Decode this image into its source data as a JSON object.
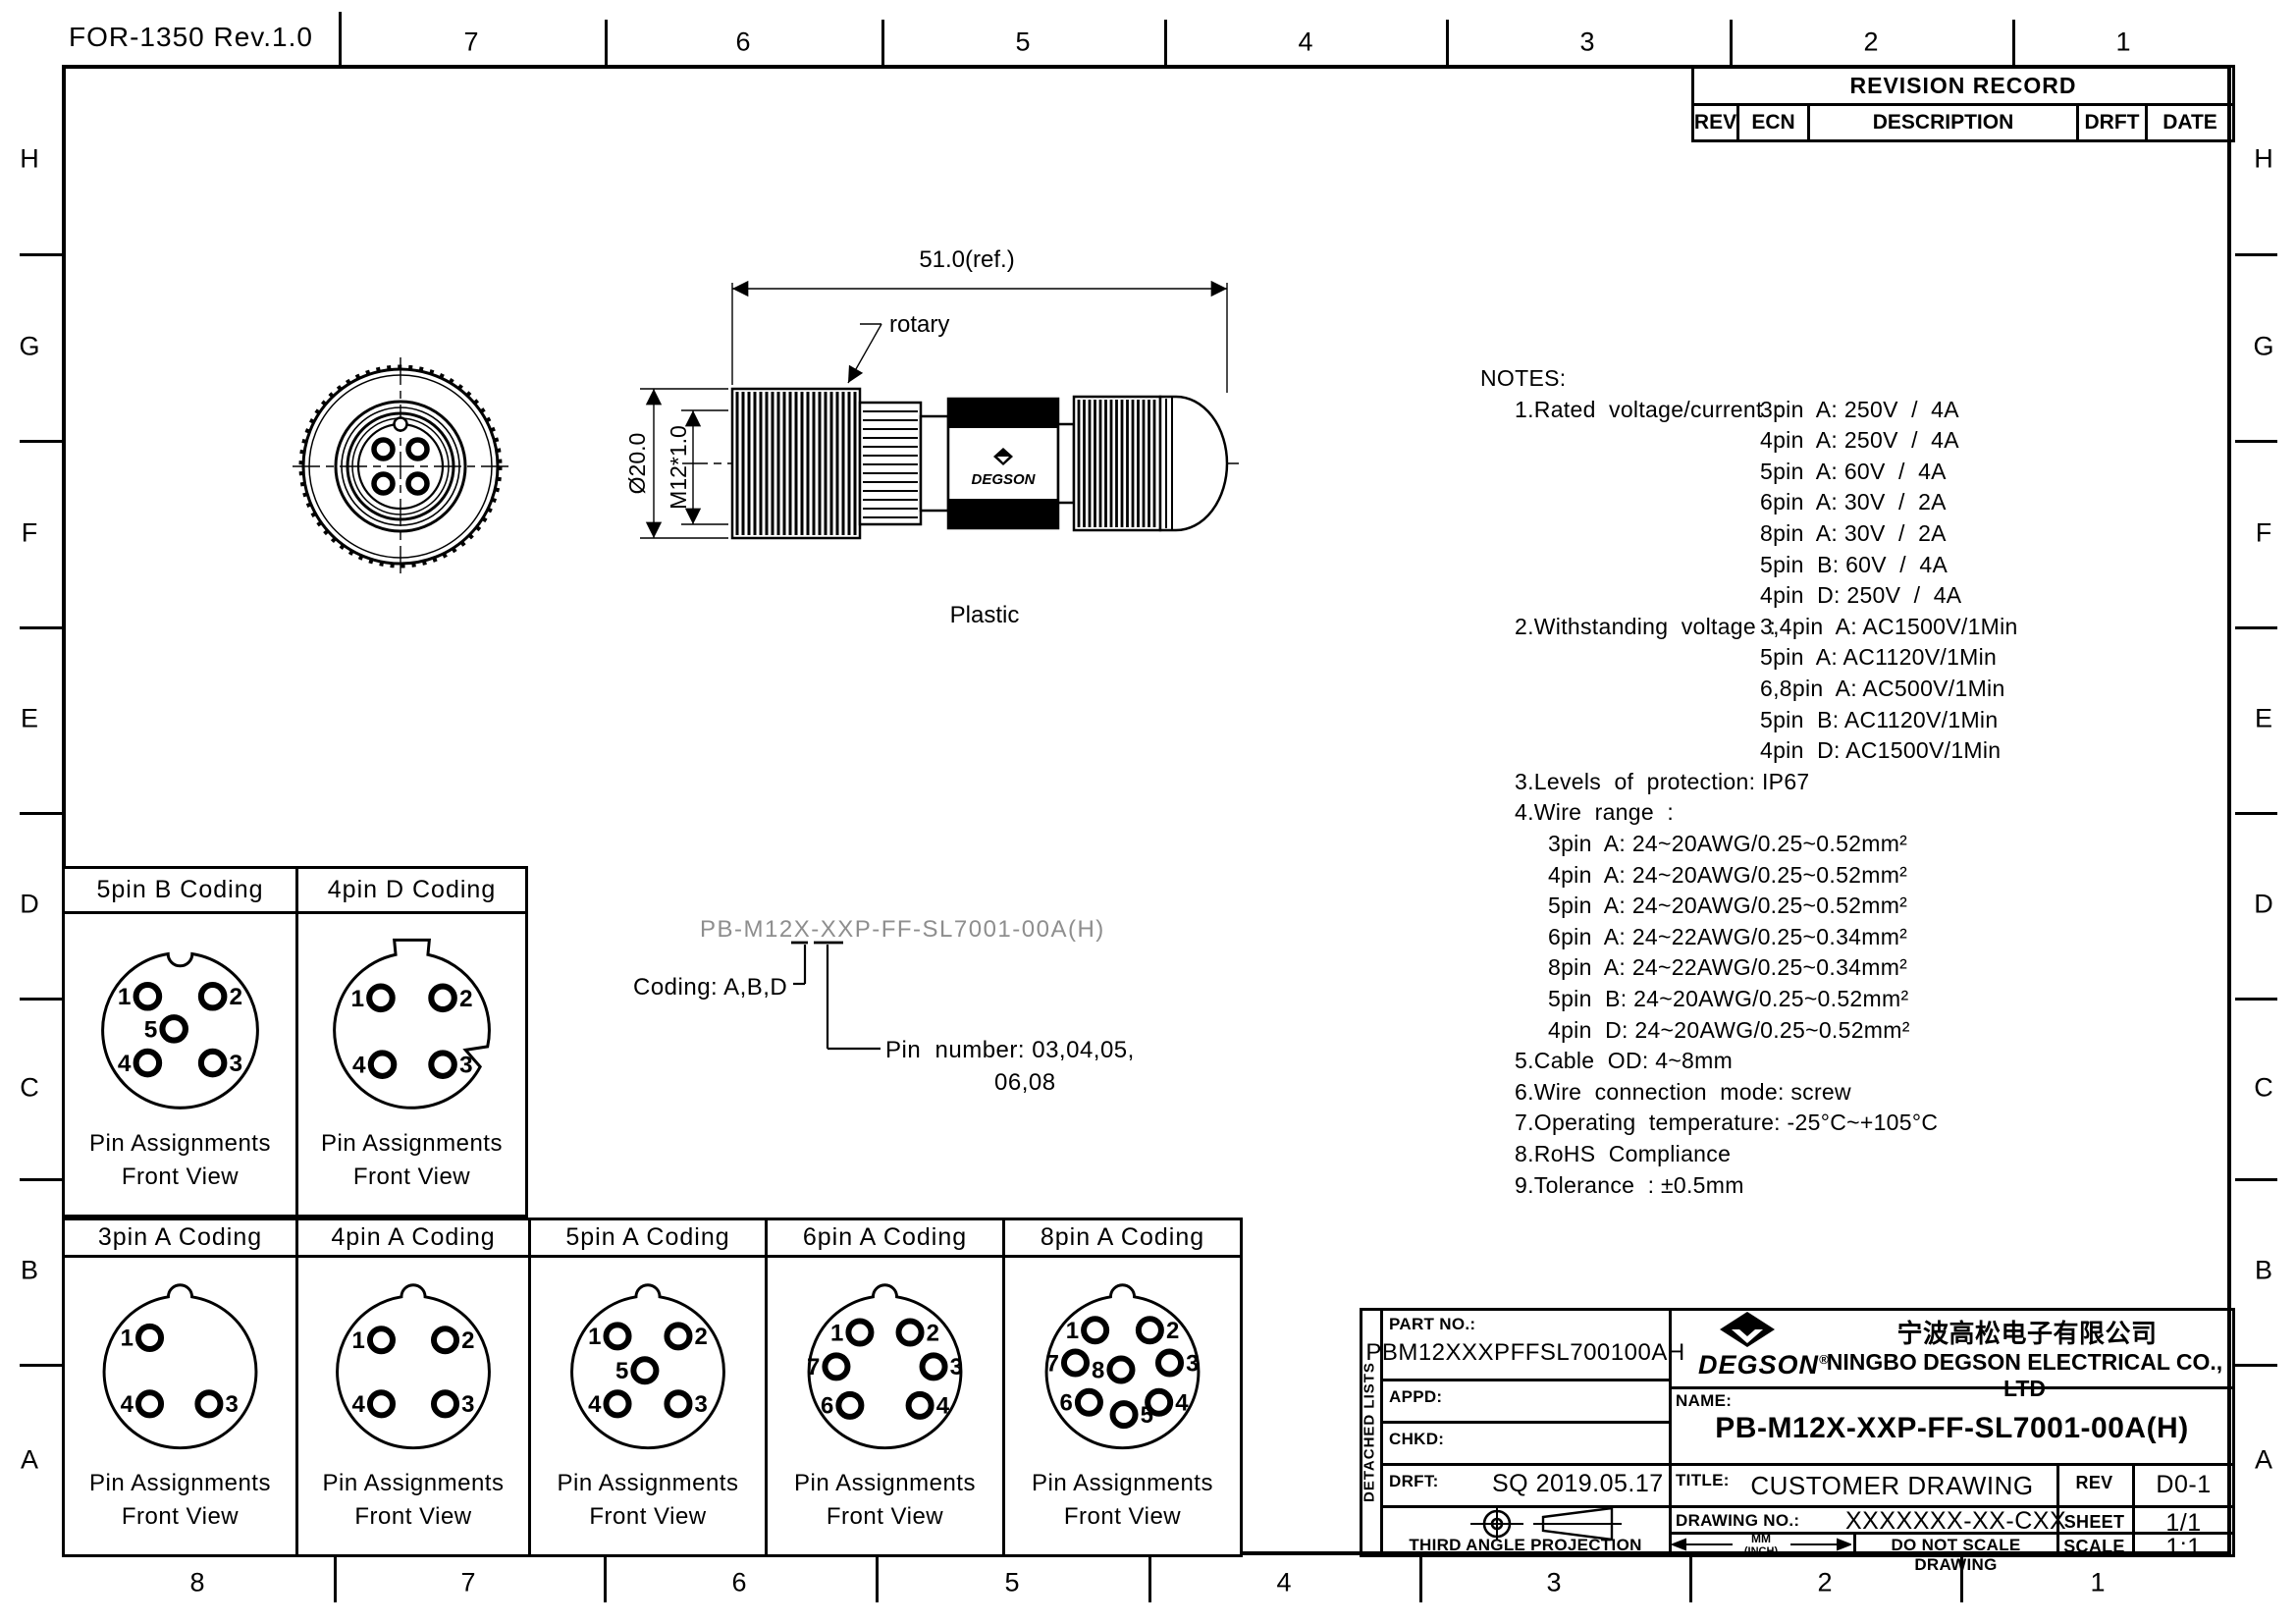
{
  "sheet": {
    "form_no": "FOR-1350 Rev.1.0",
    "top_zone_numbers": [
      "7",
      "6",
      "5",
      "4",
      "3",
      "2",
      "1"
    ],
    "bottom_zone_numbers": [
      "8",
      "7",
      "6",
      "5",
      "4",
      "3",
      "2",
      "1"
    ],
    "row_letters": [
      "H",
      "G",
      "F",
      "E",
      "D",
      "C",
      "B",
      "A"
    ]
  },
  "revision_table": {
    "title": "REVISION RECORD",
    "columns": [
      "REV",
      "ECN",
      "DESCRIPTION",
      "DRFT",
      "DATE"
    ]
  },
  "drawing": {
    "dim_length": "51.0(ref.)",
    "label_rotary": "rotary",
    "dim_diameter": "Ø20.0",
    "dim_thread": "M12*1.0",
    "label_material": "Plastic",
    "body_logo": "DEGSON"
  },
  "part_number_key": {
    "number": "PB-M12X-XXP-FF-SL7001-00A(H)",
    "coding_label": "Coding: A,B,D",
    "pin_label_line1": "Pin  number: 03,04,05,",
    "pin_label_line2": "06,08"
  },
  "notes": {
    "lines": [
      {
        "t": "NOTES:",
        "i": 0
      },
      {
        "t": "1.Rated  voltage/current  :",
        "i": 1
      },
      {
        "t": "3pin  A: 250V  /  4A",
        "i": 3,
        "j": true
      },
      {
        "t": "4pin  A: 250V  /  4A",
        "i": 3
      },
      {
        "t": "5pin  A: 60V  /  4A",
        "i": 3
      },
      {
        "t": "6pin  A: 30V  /  2A",
        "i": 3
      },
      {
        "t": "8pin  A: 30V  /  2A",
        "i": 3
      },
      {
        "t": "5pin  B: 60V  /  4A",
        "i": 3
      },
      {
        "t": "4pin  D: 250V  /  4A",
        "i": 3
      },
      {
        "t": "2.Withstanding  voltage  :",
        "i": 1
      },
      {
        "t": "3,4pin  A: AC1500V/1Min",
        "i": 3,
        "j": true
      },
      {
        "t": "5pin  A: AC1120V/1Min",
        "i": 3
      },
      {
        "t": "6,8pin  A: AC500V/1Min",
        "i": 3
      },
      {
        "t": "5pin  B: AC1120V/1Min",
        "i": 3
      },
      {
        "t": "4pin  D: AC1500V/1Min",
        "i": 3
      },
      {
        "t": "3.Levels  of  protection: IP67",
        "i": 1
      },
      {
        "t": "4.Wire  range  :",
        "i": 1
      },
      {
        "t": "3pin  A: 24~20AWG/0.25~0.52mm²",
        "i": 2
      },
      {
        "t": "4pin  A: 24~20AWG/0.25~0.52mm²",
        "i": 2
      },
      {
        "t": "5pin  A: 24~20AWG/0.25~0.52mm²",
        "i": 2
      },
      {
        "t": "6pin  A: 24~22AWG/0.25~0.34mm²",
        "i": 2
      },
      {
        "t": "8pin  A: 24~22AWG/0.25~0.34mm²",
        "i": 2
      },
      {
        "t": "5pin  B: 24~20AWG/0.25~0.52mm²",
        "i": 2
      },
      {
        "t": "4pin  D: 24~20AWG/0.25~0.52mm²",
        "i": 2
      },
      {
        "t": "5.Cable  OD: 4~8mm",
        "i": 1
      },
      {
        "t": "6.Wire  connection  mode: screw",
        "i": 1
      },
      {
        "t": "7.Operating  temperature: -25°C~+105°C",
        "i": 1
      },
      {
        "t": "8.RoHS  Compliance",
        "i": 1
      },
      {
        "t": "9.Tolerance  : ±0.5mm",
        "i": 1
      }
    ]
  },
  "pin_captions": [
    "Pin Assignments",
    "Front View"
  ],
  "codings": [
    {
      "title": "5pin B Coding",
      "variant": "B",
      "pins": [
        {
          "n": "1",
          "x": -0.42,
          "y": -0.44,
          "s": "L"
        },
        {
          "n": "2",
          "x": 0.42,
          "y": -0.44,
          "s": "R"
        },
        {
          "n": "5",
          "x": -0.08,
          "y": -0.02,
          "s": "L"
        },
        {
          "n": "4",
          "x": -0.42,
          "y": 0.42,
          "s": "L"
        },
        {
          "n": "3",
          "x": 0.42,
          "y": 0.42,
          "s": "R"
        }
      ]
    },
    {
      "title": "4pin D Coding",
      "variant": "D",
      "pins": [
        {
          "n": "1",
          "x": -0.4,
          "y": -0.42,
          "s": "L"
        },
        {
          "n": "2",
          "x": 0.4,
          "y": -0.42,
          "s": "R"
        },
        {
          "n": "4",
          "x": -0.38,
          "y": 0.44,
          "s": "L"
        },
        {
          "n": "3",
          "x": 0.4,
          "y": 0.44,
          "s": "R"
        }
      ]
    },
    {
      "title": "3pin A Coding",
      "variant": "A",
      "pins": [
        {
          "n": "1",
          "x": -0.4,
          "y": -0.45,
          "s": "L"
        },
        {
          "n": "4",
          "x": -0.4,
          "y": 0.42,
          "s": "L"
        },
        {
          "n": "3",
          "x": 0.38,
          "y": 0.42,
          "s": "R"
        }
      ]
    },
    {
      "title": "4pin A Coding",
      "variant": "A",
      "pins": [
        {
          "n": "1",
          "x": -0.42,
          "y": -0.42,
          "s": "L"
        },
        {
          "n": "2",
          "x": 0.42,
          "y": -0.42,
          "s": "R"
        },
        {
          "n": "4",
          "x": -0.42,
          "y": 0.42,
          "s": "L"
        },
        {
          "n": "3",
          "x": 0.42,
          "y": 0.42,
          "s": "R"
        }
      ]
    },
    {
      "title": "5pin A Coding",
      "variant": "A",
      "pins": [
        {
          "n": "1",
          "x": -0.4,
          "y": -0.47,
          "s": "L"
        },
        {
          "n": "2",
          "x": 0.4,
          "y": -0.47,
          "s": "R"
        },
        {
          "n": "5",
          "x": -0.04,
          "y": -0.02,
          "s": "L"
        },
        {
          "n": "4",
          "x": -0.4,
          "y": 0.42,
          "s": "L"
        },
        {
          "n": "3",
          "x": 0.4,
          "y": 0.42,
          "s": "R"
        }
      ]
    },
    {
      "title": "6pin A Coding",
      "variant": "A",
      "pins": [
        {
          "n": "1",
          "x": -0.33,
          "y": -0.52,
          "s": "L"
        },
        {
          "n": "2",
          "x": 0.33,
          "y": -0.52,
          "s": "R"
        },
        {
          "n": "7",
          "x": -0.64,
          "y": -0.07,
          "s": "L"
        },
        {
          "n": "3",
          "x": 0.64,
          "y": -0.07,
          "s": "R"
        },
        {
          "n": "6",
          "x": -0.46,
          "y": 0.44,
          "s": "L"
        },
        {
          "n": "4",
          "x": 0.46,
          "y": 0.44,
          "s": "R"
        }
      ]
    },
    {
      "title": "8pin A Coding",
      "variant": "A",
      "pins": [
        {
          "n": "1",
          "x": -0.36,
          "y": -0.55,
          "s": "L"
        },
        {
          "n": "2",
          "x": 0.36,
          "y": -0.55,
          "s": "R"
        },
        {
          "n": "7",
          "x": -0.62,
          "y": -0.12,
          "s": "L"
        },
        {
          "n": "3",
          "x": 0.62,
          "y": -0.12,
          "s": "R"
        },
        {
          "n": "8",
          "x": -0.02,
          "y": -0.03,
          "s": "L"
        },
        {
          "n": "6",
          "x": -0.44,
          "y": 0.4,
          "s": "L"
        },
        {
          "n": "5",
          "x": 0.02,
          "y": 0.56,
          "s": "R"
        },
        {
          "n": "4",
          "x": 0.48,
          "y": 0.4,
          "s": "R"
        }
      ]
    }
  ],
  "title_block": {
    "detached": "DETACHED LISTS",
    "part_no_label": "PART NO.:",
    "part_no": "PBM12XXXPFFSL700100AH",
    "appd_label": "APPD:",
    "chkd_label": "CHKD:",
    "drft_label": "DRFT:",
    "drft_value": "SQ  2019.05.17",
    "projection": "THIRD ANGLE PROJECTION",
    "brand": "DEGSON",
    "reg": "®",
    "company_cn": "宁波高松电子有限公司",
    "company_en": "NINGBO DEGSON ELECTRICAL CO., LTD",
    "name_label": "NAME:",
    "name_value": "PB-M12X-XXP-FF-SL7001-00A(H)",
    "title_label": "TITLE:",
    "title_value": "CUSTOMER  DRAWING",
    "rev_label": "REV",
    "rev_value": "D0-1",
    "dwg_label": "DRAWING NO.:",
    "dwg_value": "XXXXXXX-XX-CXX",
    "sheet_label": "SHEET",
    "sheet_value": "1/1",
    "unit_top": "MM",
    "unit_bottom": "(INCH)",
    "do_not_scale": "DO NOT SCALE DRAWING",
    "scale_label": "SCALE",
    "scale_value": "1:1"
  }
}
